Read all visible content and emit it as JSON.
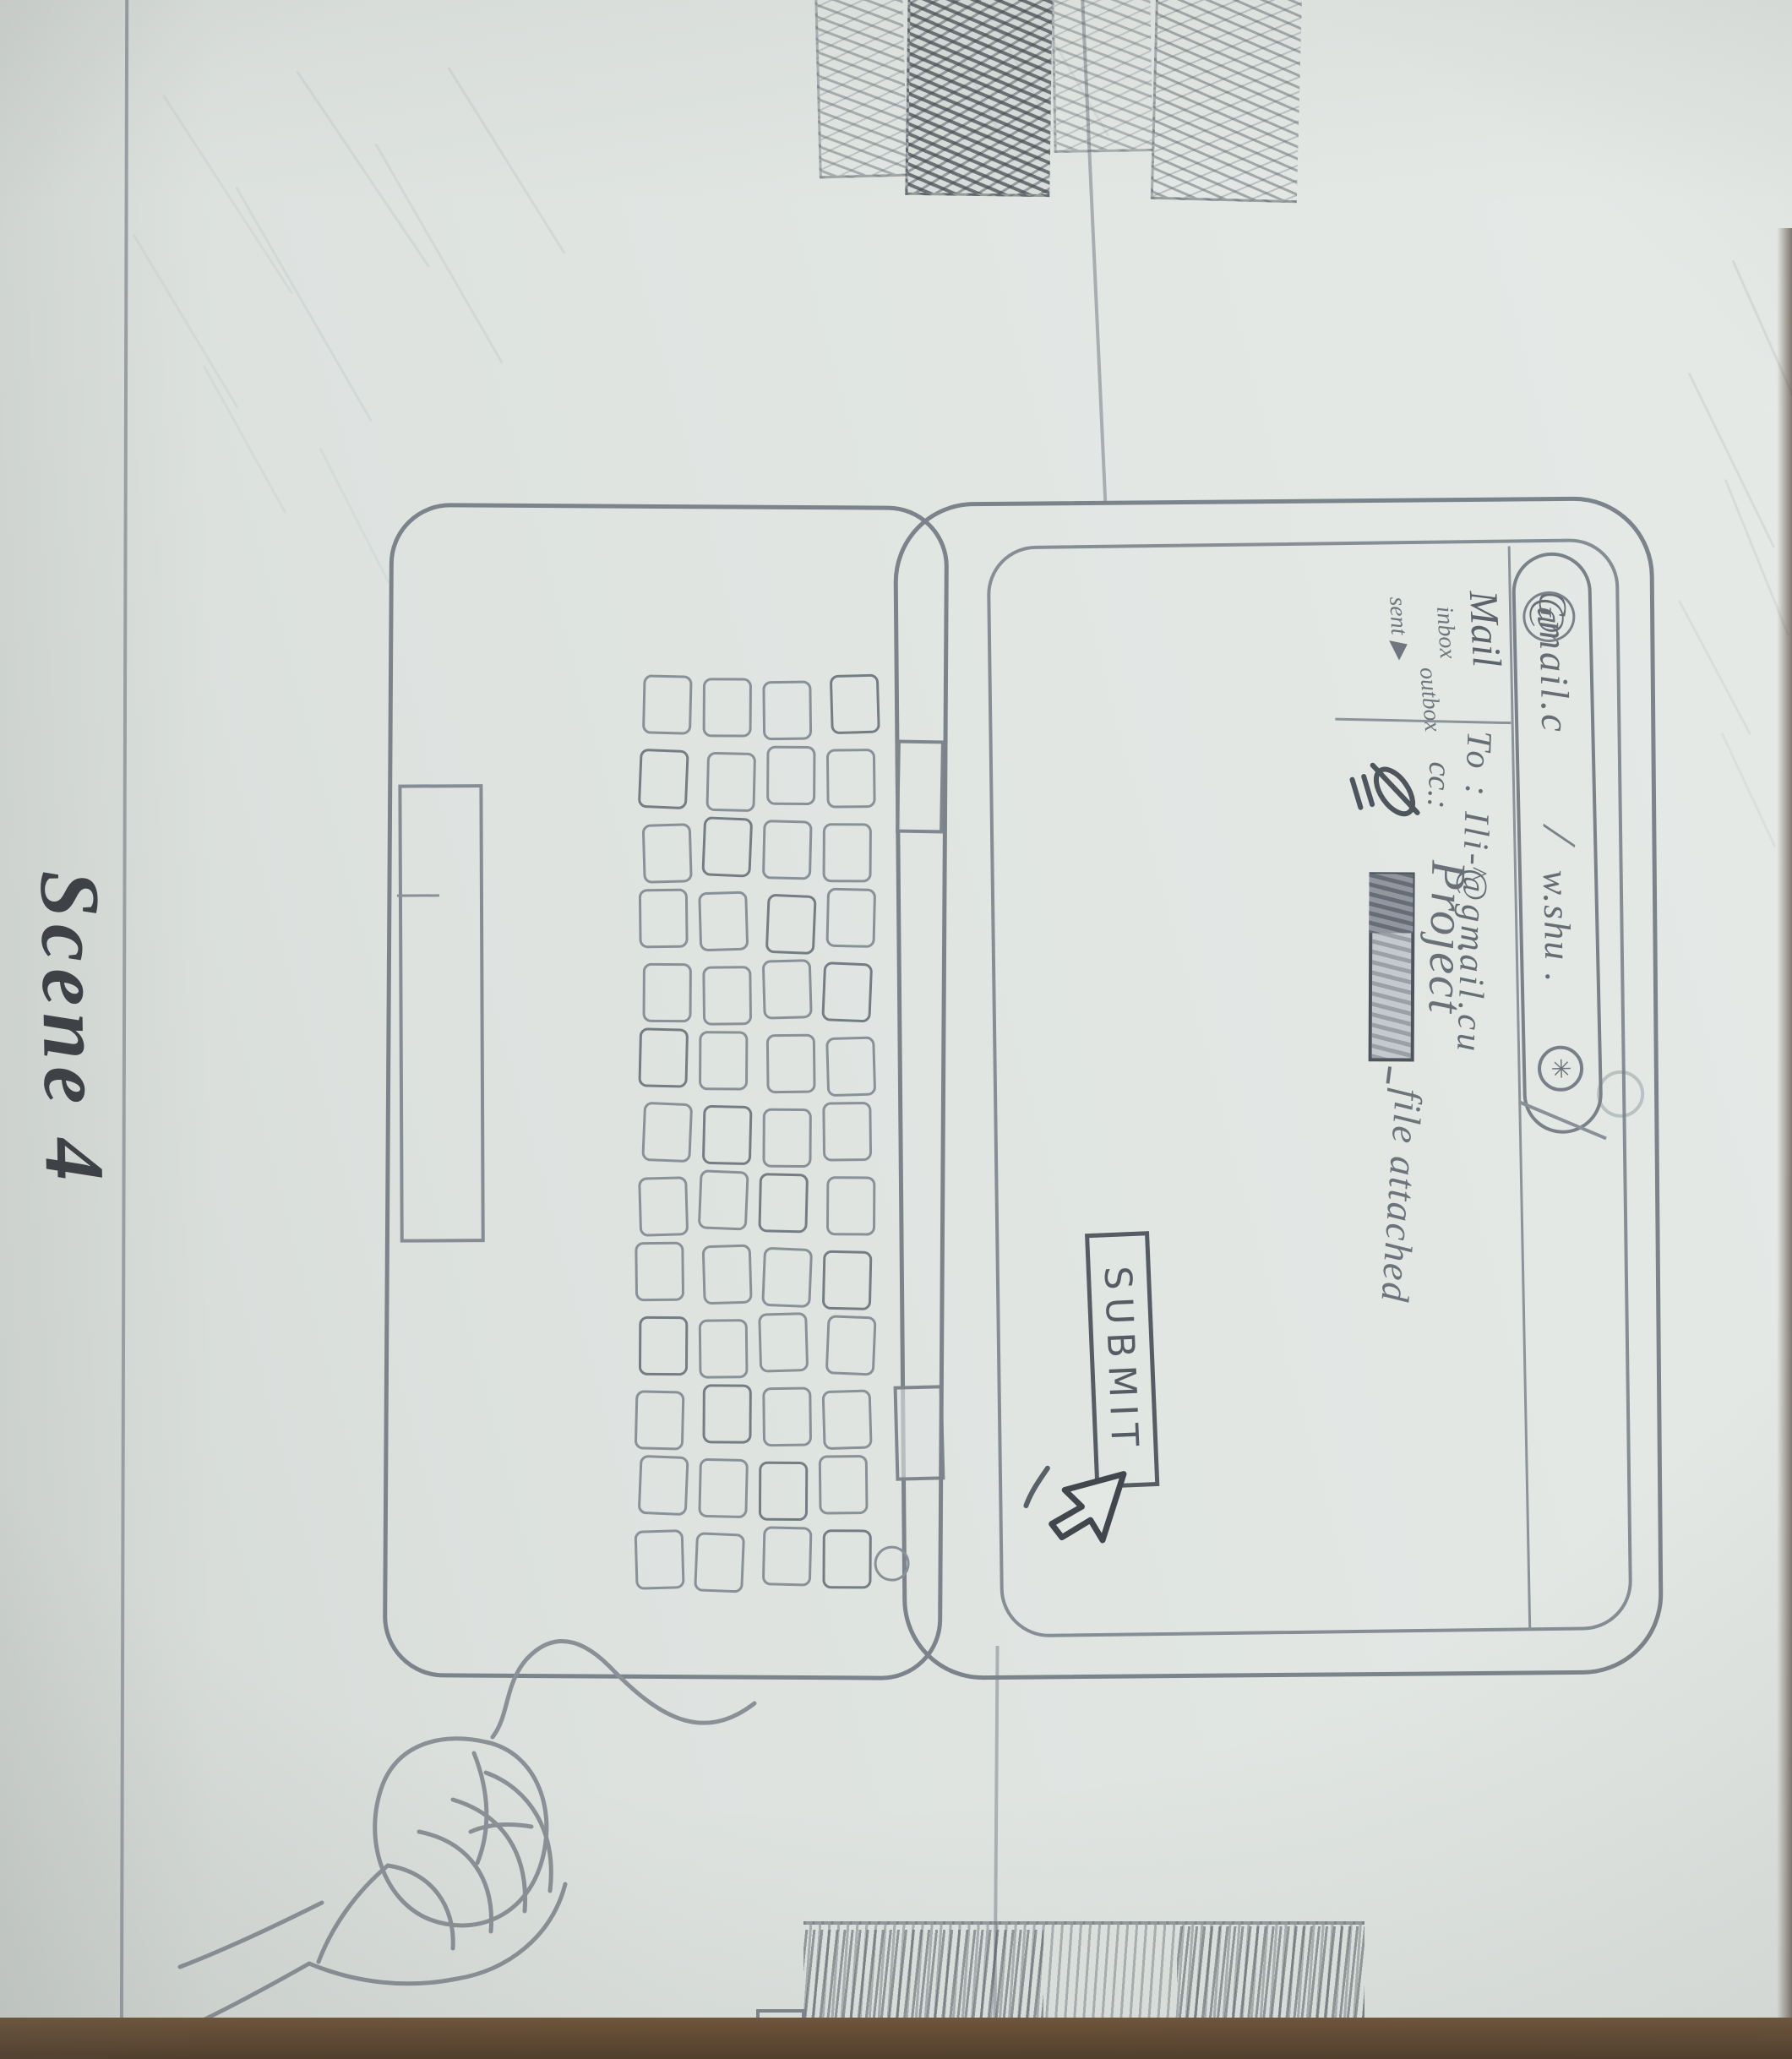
{
  "scene": {
    "caption": "Scene 4"
  },
  "browser_bar": {
    "tab_primary": "Gmail.c",
    "tab_primary_at": "@",
    "separator": "/",
    "tab_secondary": "w.shu .",
    "bar_icon_glyph": "✳"
  },
  "sidebar": {
    "title": "Mail",
    "items": [
      "inbox",
      "outbox",
      "sent ▶"
    ]
  },
  "compose": {
    "to": "To : Ili-@gmail.cu",
    "cc": "cc.:",
    "subject": "Project",
    "subject_caret": "^",
    "attachment_label": "file attached",
    "submit": "SUBMIT"
  },
  "colors": {
    "paper": "#e0e5e2",
    "pencil_light": "#b8bec2",
    "pencil": "#80868d",
    "pencil_dark": "#565c63",
    "ink_dark": "#3c4046",
    "table_brown": "#5d442f"
  }
}
